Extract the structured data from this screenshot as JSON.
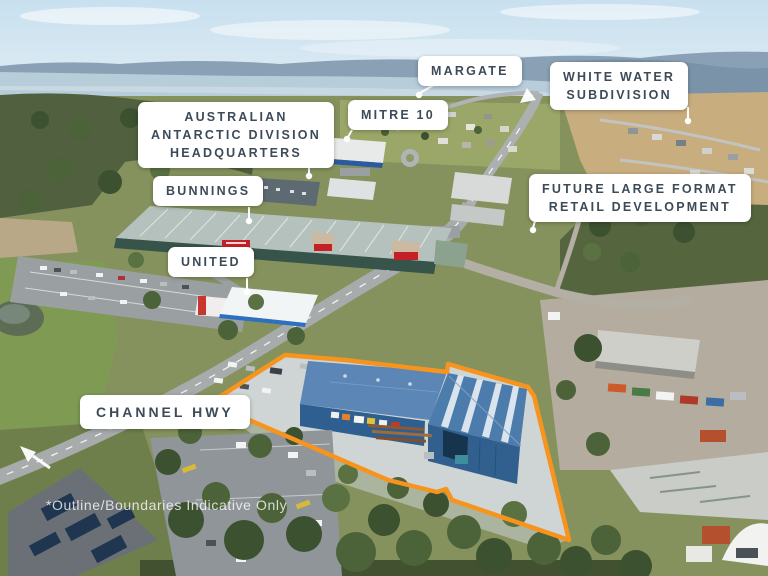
{
  "labels": {
    "margate": "MARGATE",
    "white_water_subdivision": "WHITE WATER\nSUBDIVISION",
    "mitre_10": "MITRE 10",
    "antarctic_division": "AUSTRALIAN\nANTARCTIC DIVISION\nHEADQUARTERS",
    "bunnings": "BUNNINGS",
    "future_retail": "FUTURE LARGE FORMAT\nRETAIL DEVELOPMENT",
    "united": "UNITED",
    "channel_hwy": "CHANNEL HWY"
  },
  "disclaimer": "*Outline/Boundaries Indicative Only",
  "colors": {
    "boundary_outline": "#F7941D",
    "label_background": "#FFFFFF",
    "label_text": "#3D4B58",
    "warehouse_roof_blue": "#5583B2",
    "warehouse_wall_blue": "#2F5F90",
    "leader_line": "#FFFFFF"
  }
}
